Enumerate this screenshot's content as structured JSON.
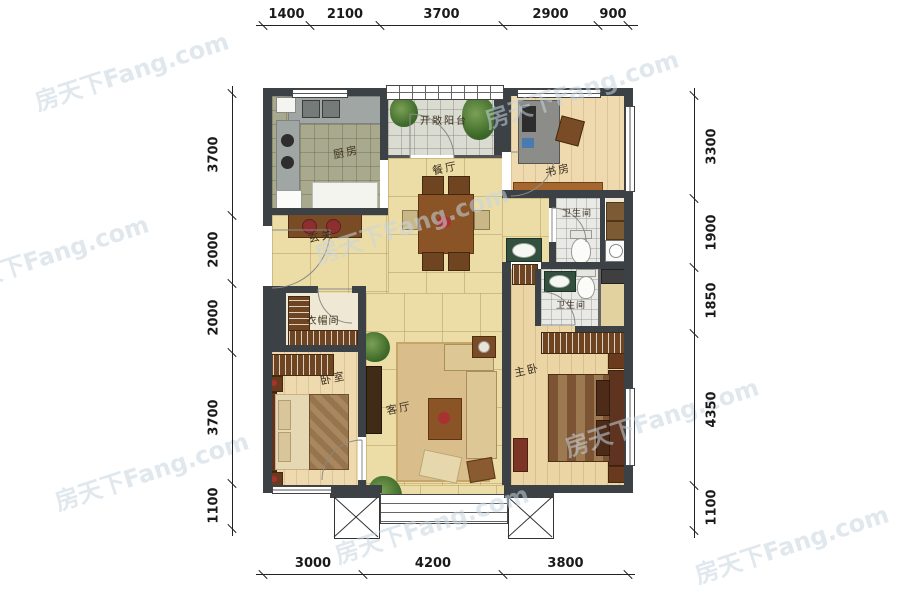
{
  "watermark": {
    "text": "房天下Fang.com"
  },
  "rooms": {
    "kitchen": "厨房",
    "balcony": "开敞阳台",
    "dining": "餐厅",
    "study": "书房",
    "bath1": "卫生间",
    "bath2": "卫生间",
    "foyer": "玄关",
    "cloakroom": "衣帽间",
    "bedroom": "卧室",
    "living": "客厅",
    "master": "主卧"
  },
  "dims": {
    "top": [
      "1400",
      "2100",
      "3700",
      "2900",
      "900"
    ],
    "bottom": [
      "3000",
      "4200",
      "3800"
    ],
    "left": [
      "3700",
      "2000",
      "2000",
      "3700",
      "1100"
    ],
    "right": [
      "3300",
      "1900",
      "1850",
      "4350",
      "1100"
    ]
  },
  "colors": {
    "wall": "#3b4145",
    "tile_beige": "#ecdca6",
    "accent_red": "#8e2f2f",
    "wood_dark": "#6f4521"
  }
}
